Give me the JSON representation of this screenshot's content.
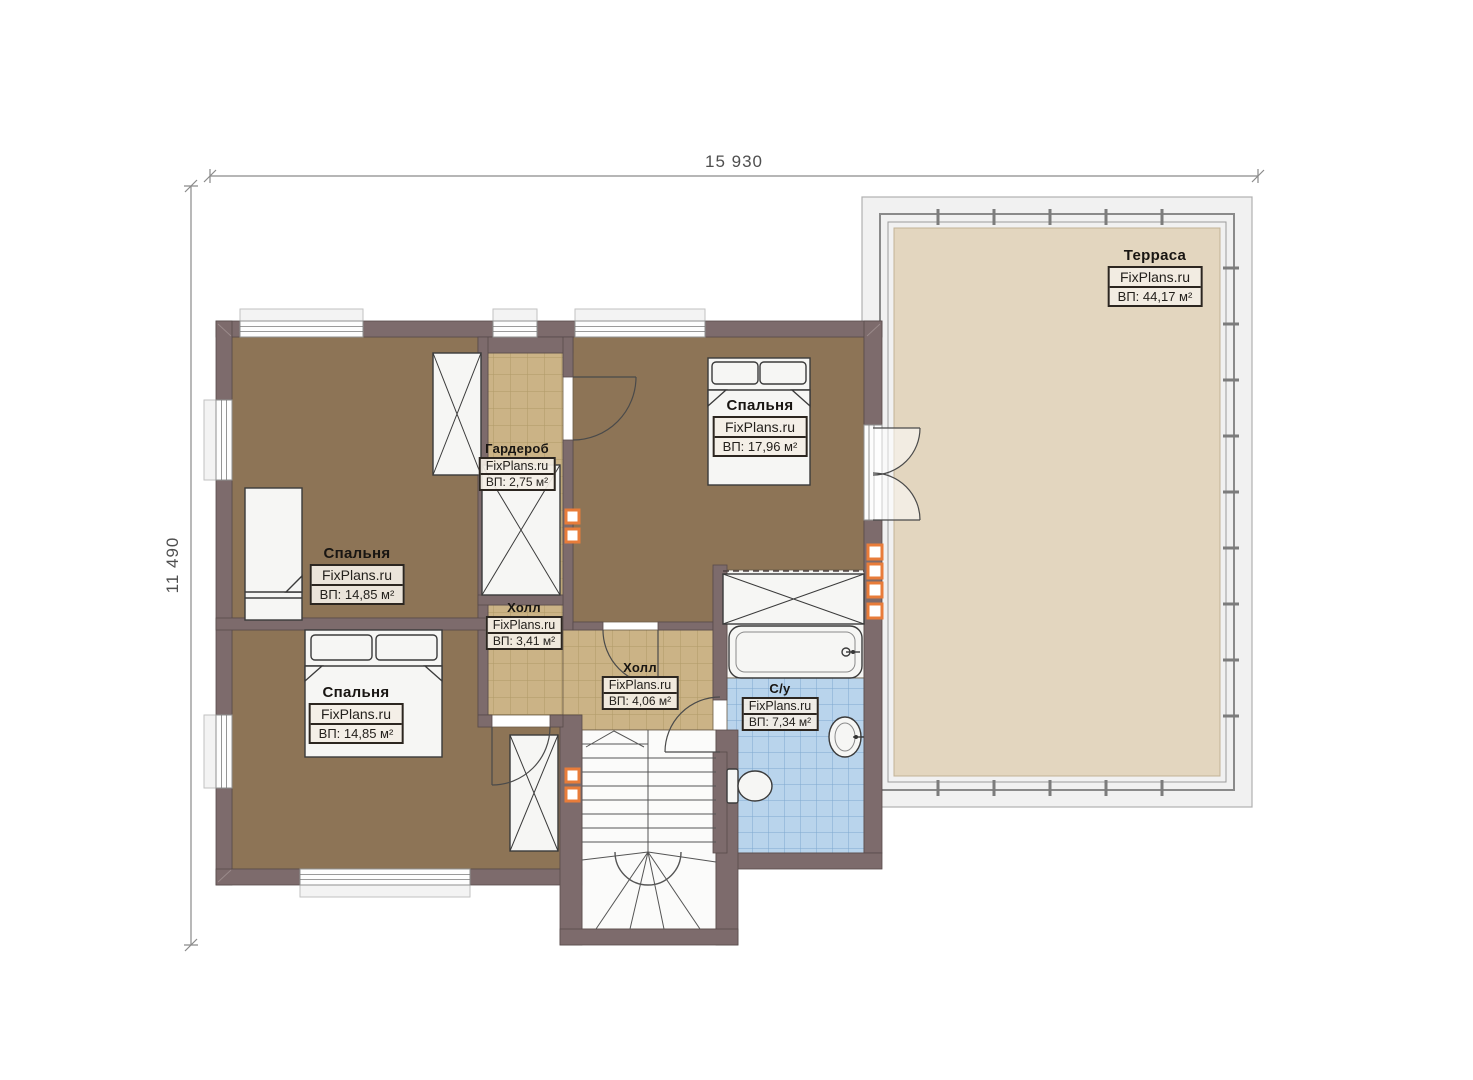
{
  "dimensions": {
    "width_label": "15 930",
    "height_label": "11 490"
  },
  "watermark": "FixPlans.ru",
  "rooms": [
    {
      "id": "terrace",
      "name": "Терраса",
      "watermark": "FixPlans.ru",
      "area": "ВП: 44,17 м²"
    },
    {
      "id": "bedroom-top-right",
      "name": "Спальня",
      "watermark": "FixPlans.ru",
      "area": "ВП: 17,96 м²"
    },
    {
      "id": "wardrobe",
      "name": "Гардероб",
      "watermark": "FixPlans.ru",
      "area": "ВП: 2,75 м²"
    },
    {
      "id": "bedroom-middle-left",
      "name": "Спальня",
      "watermark": "FixPlans.ru",
      "area": "ВП: 14,85 м²"
    },
    {
      "id": "bedroom-bottom-left",
      "name": "Спальня",
      "watermark": "FixPlans.ru",
      "area": "ВП: 14,85 м²"
    },
    {
      "id": "hall-upper",
      "name": "Холл",
      "watermark": "FixPlans.ru",
      "area": "ВП: 3,41 м²"
    },
    {
      "id": "hall-lower",
      "name": "Холл",
      "watermark": "FixPlans.ru",
      "area": "ВП: 4,06 м²"
    },
    {
      "id": "bathroom",
      "name": "С/у",
      "watermark": "FixPlans.ru",
      "area": "ВП: 7,34 м²"
    }
  ],
  "colors": {
    "wall": "#7d6b6c",
    "bedroom_floor": "#8d7456",
    "tile_floor": "#cbb386",
    "bathroom_tile": "#b9d4ec",
    "terrace_floor": "#e3d6bf",
    "marker_orange": "#e87c3a"
  }
}
